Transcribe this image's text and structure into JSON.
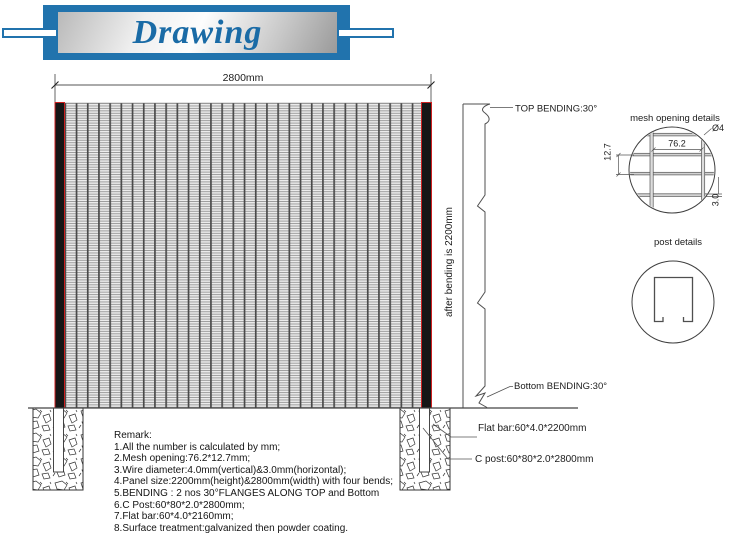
{
  "banner": {
    "title": "Drawing"
  },
  "fence": {
    "width_dimension": "2800mm",
    "height_dimension": "after bending is 2200mm",
    "top_bending_label": "TOP BENDING:30°",
    "bottom_bending_label": "Bottom BENDING:30°",
    "flat_bar_label": "Flat bar:60*4.0*2200mm",
    "c_post_label": "C post:60*80*2.0*2800mm"
  },
  "mesh_detail": {
    "title": "mesh opening details",
    "wire_diameter": "Ø4",
    "opening_width": "76.2",
    "opening_height": "12.7",
    "horizontal_wire_diameter": "3.0"
  },
  "post_detail": {
    "title": "post details"
  },
  "remark": {
    "title": "Remark:",
    "lines": [
      "1.All the number is calculated by mm;",
      "2.Mesh opening:76.2*12.7mm;",
      "3.Wire diameter:4.0mm(vertical)&3.0mm(horizontal);",
      "4.Panel size:2200mm(height)&2800mm(width) with four bends;",
      "5.BENDING : 2 nos 30°FLANGES ALONG TOP and Bottom",
      "6.C Post:60*80*2.0*2800mm;",
      "7.Flat bar:60*4.0*2160mm;",
      "8.Surface treatment:galvanized then powder coating."
    ]
  },
  "colors": {
    "banner_blue": "#2173ad",
    "title_blue": "#1a6ba6",
    "post_red": "#cc2020",
    "line_gray": "#3f3f3f"
  }
}
